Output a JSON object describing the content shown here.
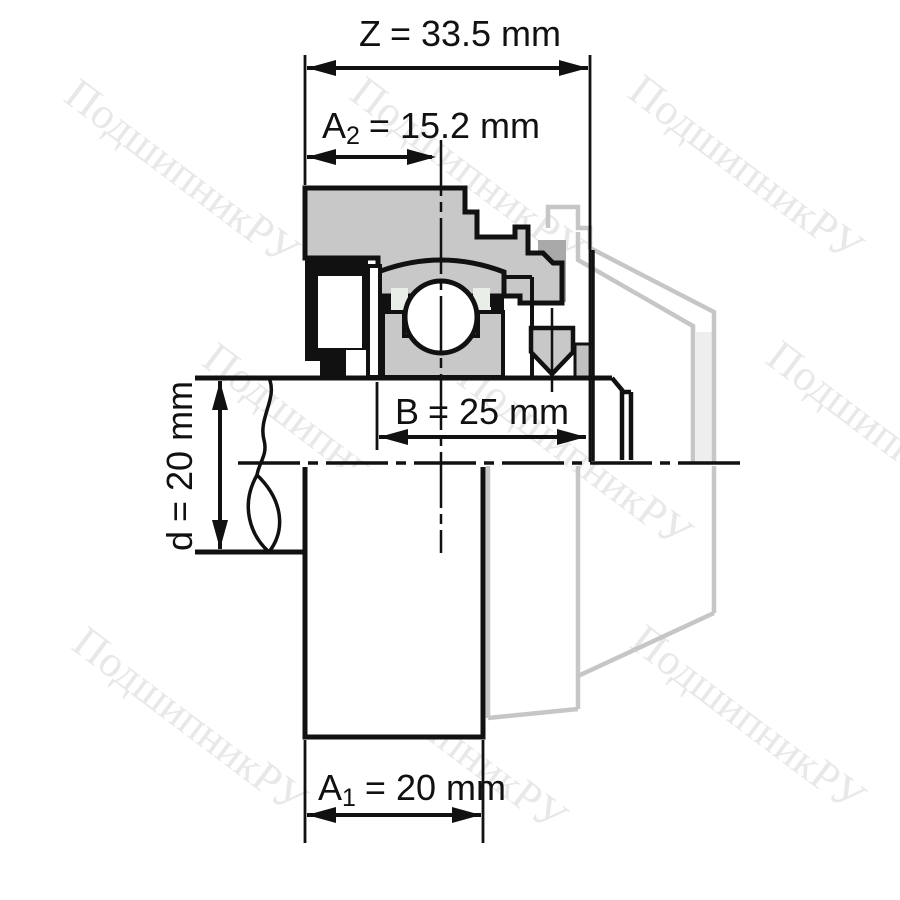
{
  "title": "Bearing unit cross-section technical drawing",
  "watermark": {
    "text": "ПодшипникРУ"
  },
  "dimensions": {
    "z": {
      "name": "Z",
      "sub": "",
      "value": "= 33.5 mm"
    },
    "a2": {
      "name": "A",
      "sub": "2",
      "value": "= 15.2 mm"
    },
    "b": {
      "name": "B",
      "sub": "",
      "value": "= 25 mm"
    },
    "d": {
      "name": "d",
      "sub": "",
      "value": "= 20 mm"
    },
    "a1": {
      "name": "A",
      "sub": "1",
      "value": "= 20 mm"
    }
  },
  "colors": {
    "line": "#111111",
    "gray": "#c8c8c8",
    "cage": "#e9efe8",
    "ghost": "#c6c6c6",
    "dark": "#a9a9a9",
    "wm": "#e8e8e8",
    "bg": "#ffffff"
  }
}
